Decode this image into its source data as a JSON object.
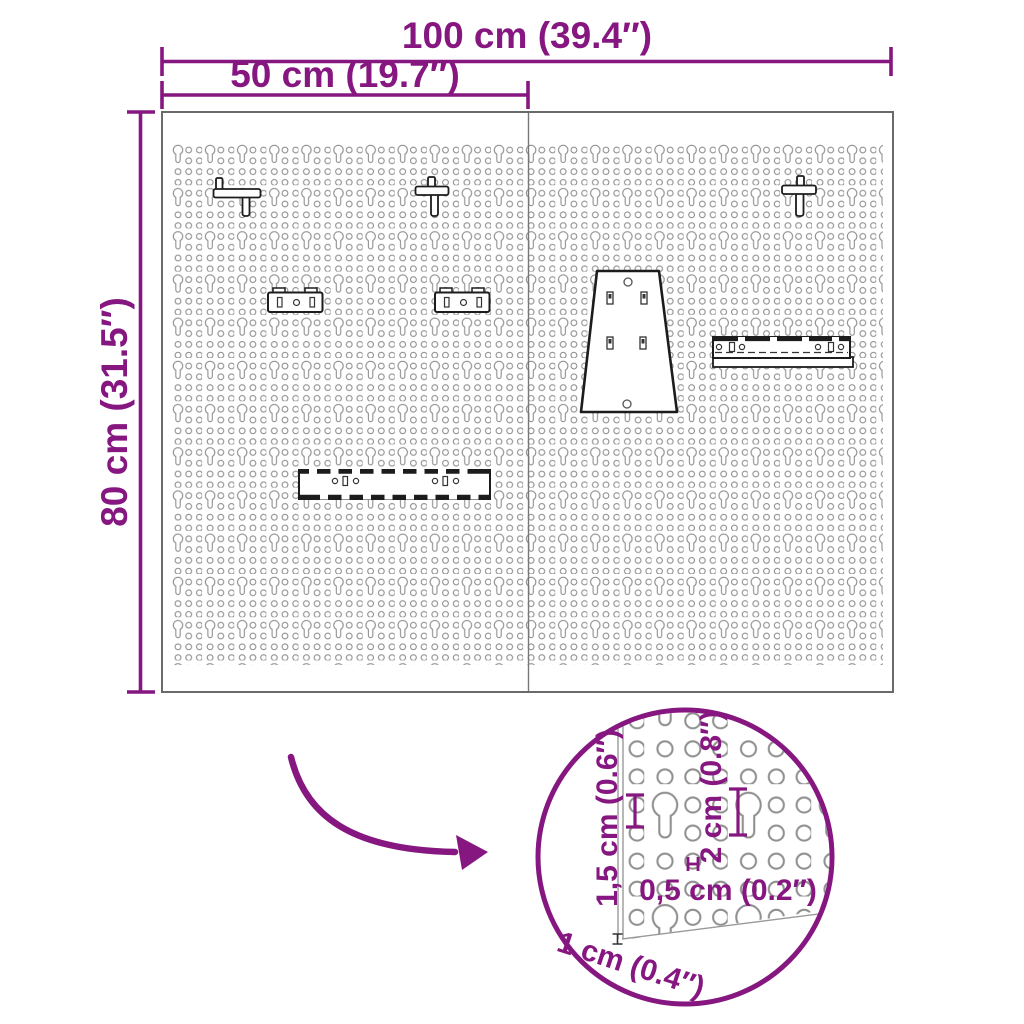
{
  "title": "Pegboard wall panel dimension diagram",
  "colors": {
    "accent": "#861780",
    "board_border": "#6a6a6a",
    "hole_outline": "#8f8f8f",
    "accessory_outline": "#1c1c1c"
  },
  "dimensions": {
    "total_width": "100 cm (39.4″)",
    "panel_width": "50 cm (19.7″)",
    "height": "80 cm (31.5″)"
  },
  "detail": {
    "hole_pitch": "1,5 cm (0.6″)",
    "keyhole_height": "2 cm (0.8″)",
    "hole_gap": "0,5 cm (0.2″)",
    "board_thickness": "1 cm (0.4″)"
  }
}
